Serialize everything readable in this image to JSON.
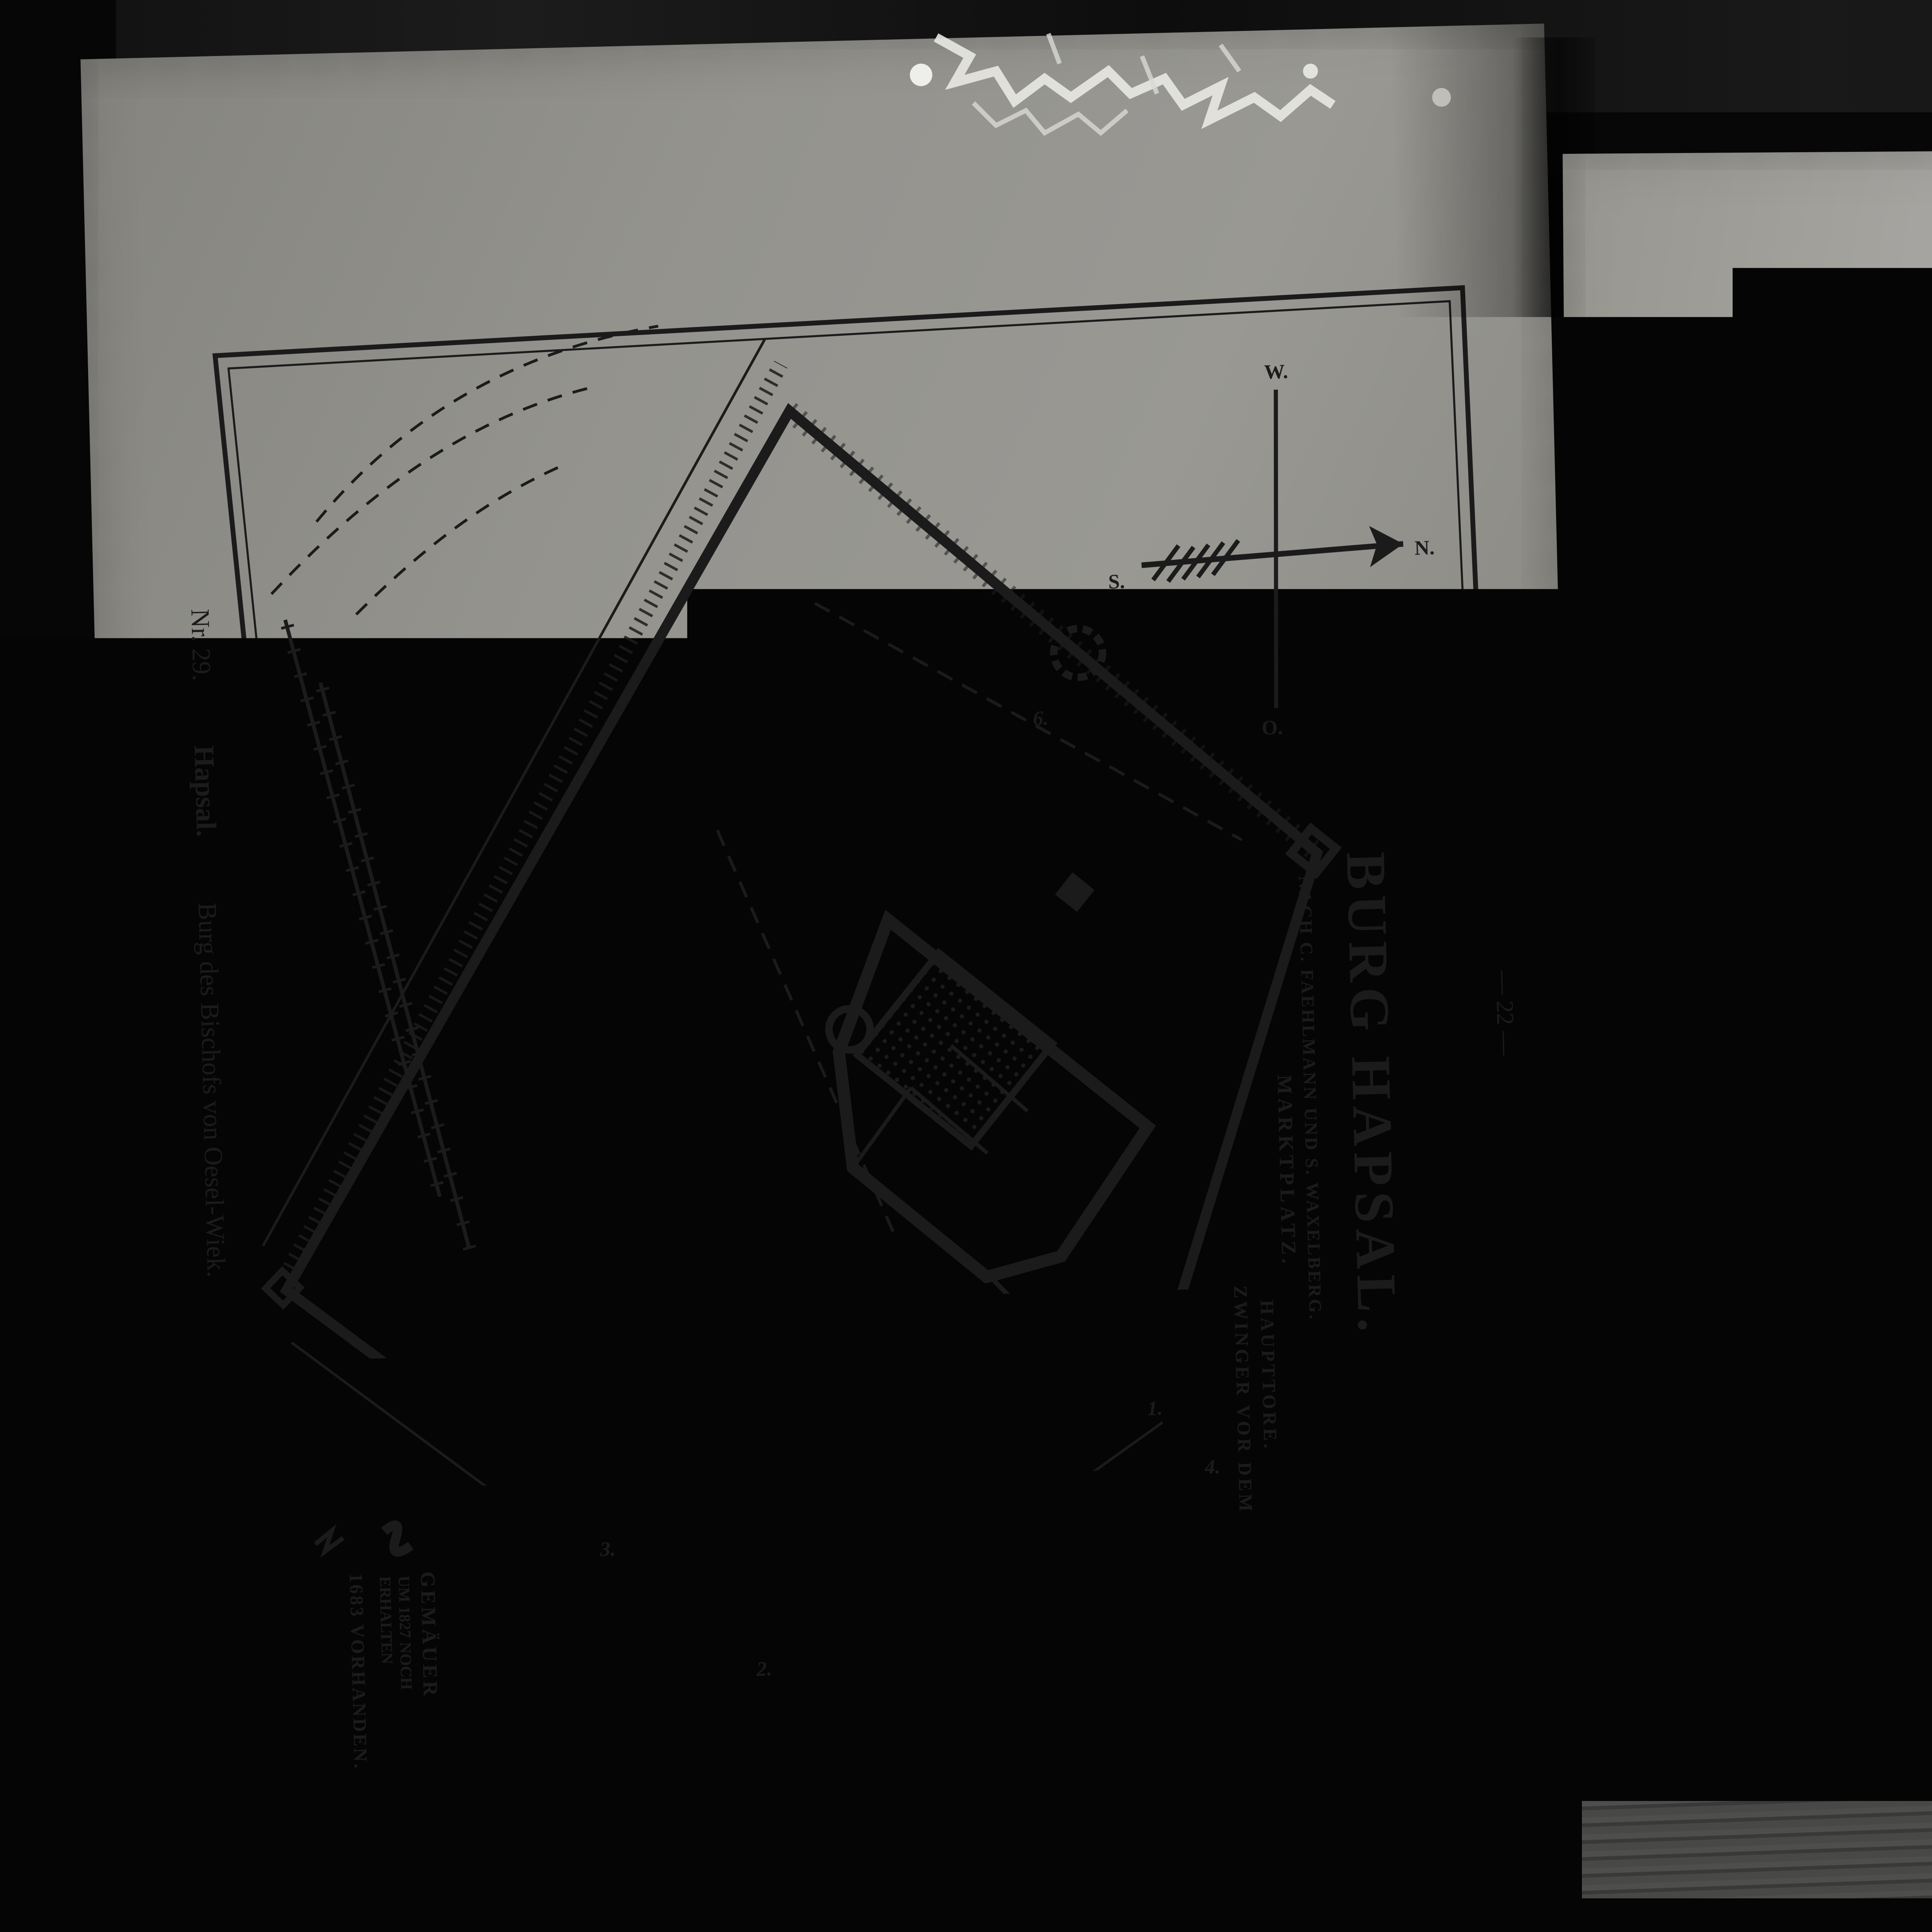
{
  "left_page": {
    "page_number": "— 22 —",
    "caption": {
      "nr": "Nr. 29.",
      "name": "Hapsal.",
      "rest": "Burg des Bischofs von Oesel-Wiek."
    },
    "title": "BURG HAPSAL.",
    "subtitle": "NACH C. FAEHLMANN UND S. WAXELBERG.",
    "compass": {
      "n": "N.",
      "s": "S.",
      "w": "W.",
      "o": "O."
    },
    "labels": {
      "stadt_top": "STADT HAPSAL.",
      "stadt_bottom": "STADT HAPSAL",
      "graben_top": "GRABEN.",
      "erdwall_top": "ERDWALL.",
      "wall": "WALL.",
      "wachtturm": "WACHTTURM",
      "kathedrale": "KATHEDRALE.",
      "taufkapelle": "TAUFKAPELLE.",
      "gewoelbe": "GEWÖLBE",
      "sakristei": "SAKRISTEI.",
      "glockenturm": "ALTER GLOCKENTURM.",
      "erdwall_left": "ERDWALL",
      "graben_left": "GRABEN.",
      "graben_right": "GRABEN.",
      "erdwall_bottom": "ERDWALL",
      "graben_bottom": "GRABEN",
      "marktplatz": "MARKTPLATZ.",
      "zwinger1": "ZWINGER VOR DEM",
      "zwinger2": "HAUPTTORE.",
      "strasse_nach_reval": "STRASSE NACH REVAL.",
      "nach_pernau": "NACH PERNAU.",
      "gaerten": "GÄRTEN.",
      "faden": "FADEN.",
      "meter": "METER."
    },
    "scale_numbers": "10  20  30  40  50",
    "legend": {
      "sym1_line1": "GEMÄUER",
      "sym1_line2": "UM 1827 NOCH",
      "sym1_line3": "ERHALTEN",
      "sym2": "1683 VORHANDEN."
    },
    "numbers": [
      "1.",
      "2.",
      "3.",
      "4.",
      "6."
    ]
  },
  "right_page": {
    "page_number": "— 34 —",
    "caption": "Nr. 48.  Ordenskomturei und Stadtmauer von Pernau.",
    "title": "PERNAU",
    "attribution1": "NACH PLÄNEN",
    "attribution2": "VON 1640,",
    "attribution3": "1668 und 1696.",
    "signature1": "K. Löwis",
    "signature2": "1914.",
    "compass": {
      "n": "N.",
      "s": "S.",
      "w": "W.",
      "o": "O."
    },
    "streets": {
      "wallgraben_top": "WALLGRABEN",
      "westgasse": "WESTGASSE",
      "revaler": "REVALER STRASSE",
      "akademie": "AKADEMIE STRASSE",
      "wasser": "WASSER STRASSE",
      "moench": "MÖNCH GASSE",
      "nikolai": "NIKOLAI STRASSE",
      "gilden": "GILDEN ODER SCH",
      "malgasse": "MALGASSE",
      "heil_geist": "HEIL. GEIST GASSE",
      "hospital": "HOSPITAL GASSE",
      "ostgasse": "OSTGASSE",
      "wallgraben_bottom": "WALLGRABEN",
      "koenigs1": "KÖNIGS",
      "koenigs2": "STRASSE",
      "ritter1": "RITTER",
      "ritter2": "STRASSE",
      "neugasse": "NEUGASSE",
      "malmoe": "MALMÖ STRASSE",
      "lang": "LANG STRASSE",
      "nordgraben": "NORDGRABEN"
    },
    "places": {
      "neuer1": "NEUER",
      "neuer2": "MARKT",
      "alter1": "ALTER",
      "alter2": "MARKT",
      "nikolai1": "NIKOLAI",
      "nikolai2": "KIRCHE",
      "johannis1": "JOHANNIS",
      "johannis2": "KIRCHE",
      "konvent": "KONVENT",
      "innere1": "INNERE",
      "innere2": "VORBURG",
      "aeussere": "ÄUSSERE VORBURG",
      "ordensburg": "DEUTSCH-ORDENS-BURG"
    },
    "bastions": {
      "soll1": "SOLL",
      "soll2": "BASTION",
      "venus1": "VENUS",
      "venus2": "BASTION",
      "saturnus1": "SATURNUS",
      "saturnus2": "BASTION",
      "mars1": "MARS",
      "mars2": "BASTION",
      "luna1": "LUNA",
      "luna2": "BASTION"
    },
    "gates": {
      "g1a": "REVALER",
      "g1b": "ODER",
      "g1c": "KARL-GUSTAV-TOR",
      "g2a": "RIGASCHES",
      "g2b": "ODER",
      "g2c": "KARLS-TOR"
    },
    "scale": {
      "label": "REINLÄNDISCHE RUTEN",
      "numbers": "0   10   20   30   40"
    },
    "numbers": [
      "1",
      "2",
      "3",
      "4",
      "5",
      "6",
      "7",
      "8",
      "10",
      "11",
      "12",
      "13",
      "14",
      "15",
      "16",
      "17",
      "18",
      "19"
    ]
  }
}
